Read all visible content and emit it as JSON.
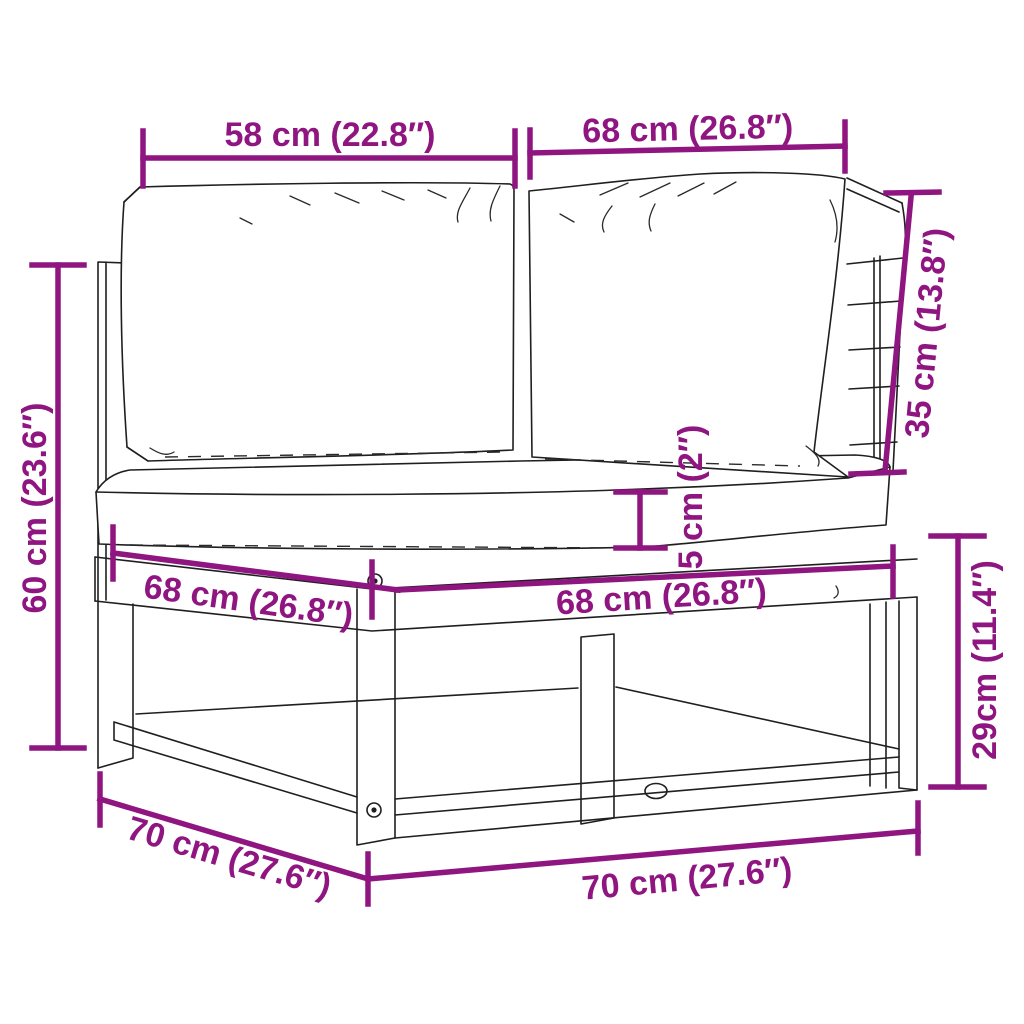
{
  "figure": {
    "type": "product-dimension-diagram",
    "subject": "corner-sofa-section-with-cushions",
    "style": "black line art with magenta dimension annotations on white"
  },
  "colors": {
    "dimension_accent": "#8F1581",
    "line_art": "#1f1f1f",
    "background": "#ffffff"
  },
  "dims": [
    {
      "id": "back-width-left",
      "label": "58 cm (22.8″)"
    },
    {
      "id": "back-width-right",
      "label": "68 cm (26.8″)"
    },
    {
      "id": "backrest-height",
      "label": "35 cm (13.8″)"
    },
    {
      "id": "overall-height",
      "label": "60 cm (23.6″)"
    },
    {
      "id": "seat-cushion-thickness",
      "label": "5 cm (2″)"
    },
    {
      "id": "seat-depth-left",
      "label": "68 cm (26.8″)"
    },
    {
      "id": "seat-width-front",
      "label": "68 cm (26.8″)"
    },
    {
      "id": "base-height",
      "label": "29cm (11.4″)"
    },
    {
      "id": "base-depth",
      "label": "70 cm (27.6″)"
    },
    {
      "id": "base-width",
      "label": "70 cm (27.6″)"
    }
  ]
}
